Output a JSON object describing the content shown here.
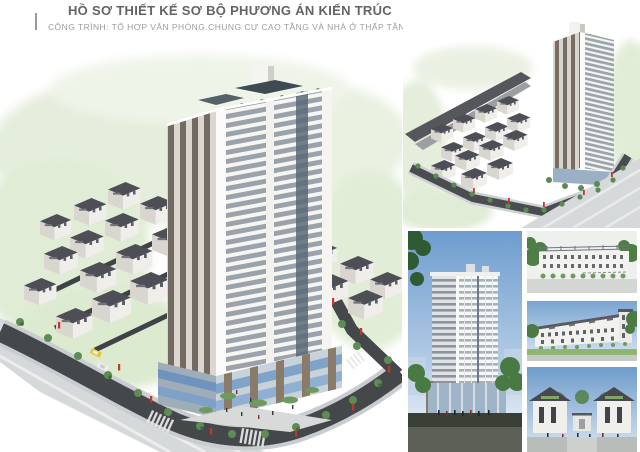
{
  "header": {
    "title": "HỒ SƠ THIẾT KẾ SƠ BỘ PHƯƠNG ÁN KIẾN TRÚC",
    "project": "CÔNG TRÌNH: TỔ HỢP VĂN PHÒNG,CHUNG CƯ CAO TẦNG VÀ NHÀ Ở THẤP TẦNG",
    "location": "ĐỊA ĐIỂM: PHƯỜNG THỊNH LIỆT, QUẬN HOÀNG MAI, HÀ NỘI"
  },
  "colors": {
    "title_text": "#646464",
    "subtitle_text": "#9c9c9c",
    "location_text": "#b3b3b3",
    "sky_blue": "#6e9dcf",
    "sky_light": "#d8e5f1",
    "foliage_pale": "#e4eedb",
    "tree_green": "#5d8c55",
    "shrub_green": "#6f9a5f",
    "roof_dark": "#4d4e56",
    "asphalt": "#45484b",
    "road_light": "#d6d9da",
    "facade_white": "#f6f6f2",
    "window_band": "#9aa3ab",
    "glass_blue": "#7c9cc4",
    "podium_brown": "#8a7b68",
    "banner_red": "#c0392b",
    "taxi_yellow": "#e6c33c"
  }
}
